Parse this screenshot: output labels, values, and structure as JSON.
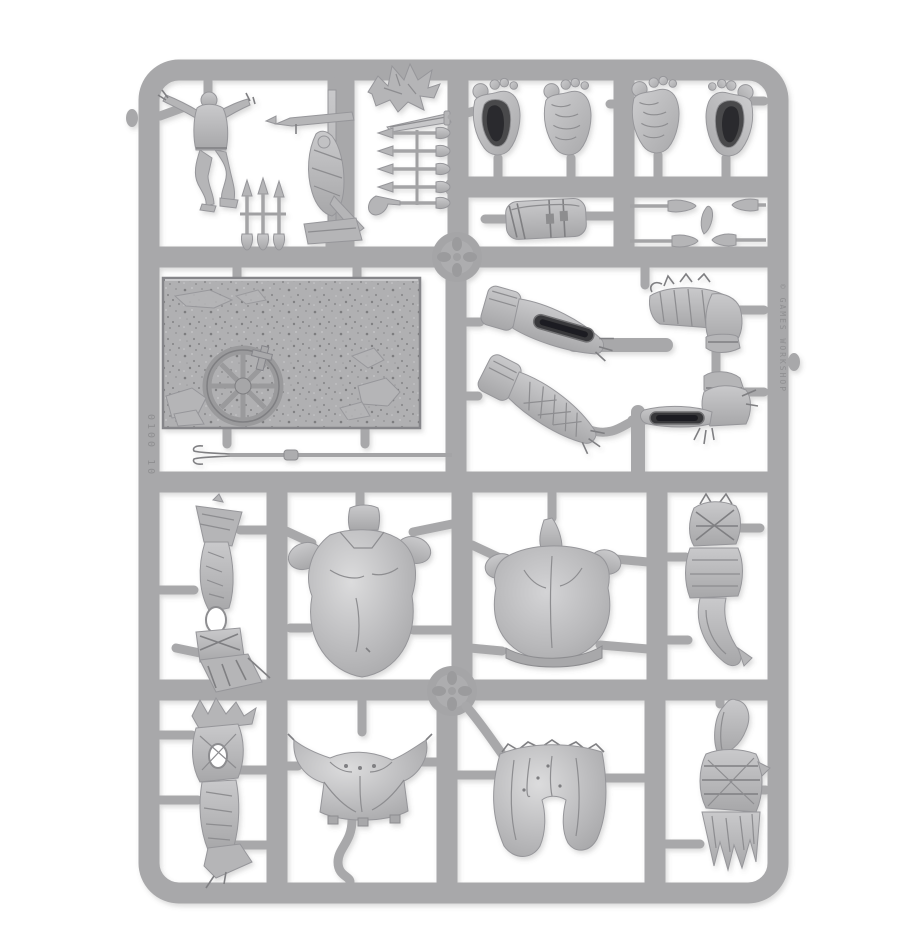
{
  "photo": {
    "subject": "grey plastic miniature model sprue on white background",
    "material_color": "#a8a8aa"
  },
  "colors": {
    "background": "#ffffff",
    "sprue_rail": "#a8a8aa",
    "part_base": "#b5b5b7",
    "part_light": "#c6c6c8",
    "part_highlight": "#dadadb",
    "recess": "#57575a",
    "deep_slot": "#2c2c2e",
    "outline": "#96969a"
  },
  "markings": {
    "left_rail_vertical": "0100 10",
    "right_rail_vertical": "© GAMES WORKSHOP"
  },
  "parts": [
    {
      "id": "victim-figure",
      "label": "spread-armed figure"
    },
    {
      "id": "gibbet-pole",
      "label": "gibbet pole with bound corpse"
    },
    {
      "id": "crumpled-figure",
      "label": "crumpled creature"
    },
    {
      "id": "sword-blade",
      "label": "sword blade"
    },
    {
      "id": "arrow-rack",
      "label": "rack of five arrows"
    },
    {
      "id": "standing-arrows",
      "label": "three standing arrows"
    },
    {
      "id": "giant-foot-inner-left",
      "label": "giant foot inner half"
    },
    {
      "id": "giant-foot-outer-left",
      "label": "giant foot outer half"
    },
    {
      "id": "giant-foot-outer-right",
      "label": "giant foot outer half"
    },
    {
      "id": "giant-foot-inner-right",
      "label": "giant foot inner half"
    },
    {
      "id": "wrapped-bracer",
      "label": "wrapped bracer"
    },
    {
      "id": "spear-group",
      "label": "spears and leaf blade"
    },
    {
      "id": "base-plate",
      "label": "textured base plate with cart wheel"
    },
    {
      "id": "two-prong-fork",
      "label": "two-pronged fork"
    },
    {
      "id": "forearm-socket",
      "label": "forearm half with open socket"
    },
    {
      "id": "forearm-wrapped",
      "label": "bandaged forearm half"
    },
    {
      "id": "bent-arm-furred",
      "label": "bent arm with furred sleeve"
    },
    {
      "id": "bent-arm-socket",
      "label": "bent arm half with open socket"
    },
    {
      "id": "tattered-banner",
      "label": "tattered banner club"
    },
    {
      "id": "torso-front",
      "label": "giant torso front"
    },
    {
      "id": "torso-back",
      "label": "giant torso back"
    },
    {
      "id": "bound-tail",
      "label": "bound tail bundle"
    },
    {
      "id": "spiked-banner",
      "label": "spiked banner"
    },
    {
      "id": "horned-pelvis",
      "label": "horned pelvis plate"
    },
    {
      "id": "loincloth",
      "label": "loincloth pelvis"
    },
    {
      "id": "wrapped-haunch",
      "label": "wrapped haunch with tassels"
    }
  ]
}
